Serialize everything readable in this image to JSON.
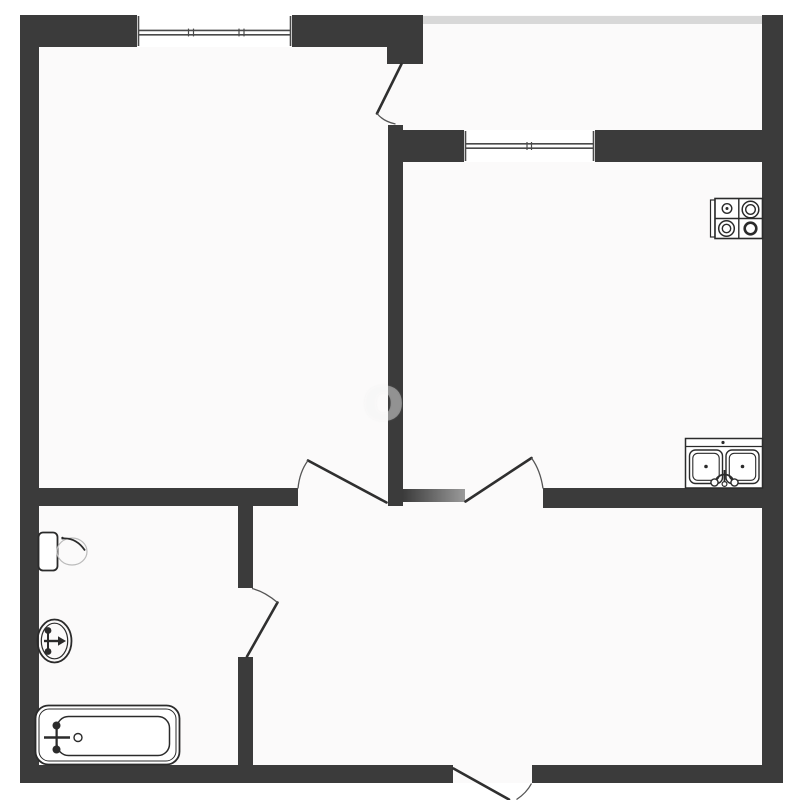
{
  "title": "apartment-floor-plan",
  "colors": {
    "page_bg": "#ffffff",
    "floor_color": "#fbfafa",
    "wall_color": "#3b3b3b",
    "balcony_edge_color": "#d8d8d8",
    "partition_end_color": "#9a9a9a",
    "window_line_color": "#4a4a4a",
    "door_color": "#2f2f2f",
    "arc_color": "#555555",
    "fixture_color": "#2b2b2b",
    "faint_color": "#bbbbbb"
  },
  "watermark": {
    "text": "о"
  },
  "windows": [
    {
      "name": "living-room-window"
    },
    {
      "name": "kitchen-window"
    }
  ],
  "doors": [
    {
      "name": "balcony-door"
    },
    {
      "name": "living-room-door"
    },
    {
      "name": "kitchen-door"
    },
    {
      "name": "bathroom-door"
    },
    {
      "name": "entry-door"
    }
  ],
  "fixtures": [
    {
      "name": "stove-icon"
    },
    {
      "name": "kitchen-sink-icon"
    },
    {
      "name": "toilet-icon"
    },
    {
      "name": "washbasin-icon"
    },
    {
      "name": "bathtub-icon"
    }
  ]
}
